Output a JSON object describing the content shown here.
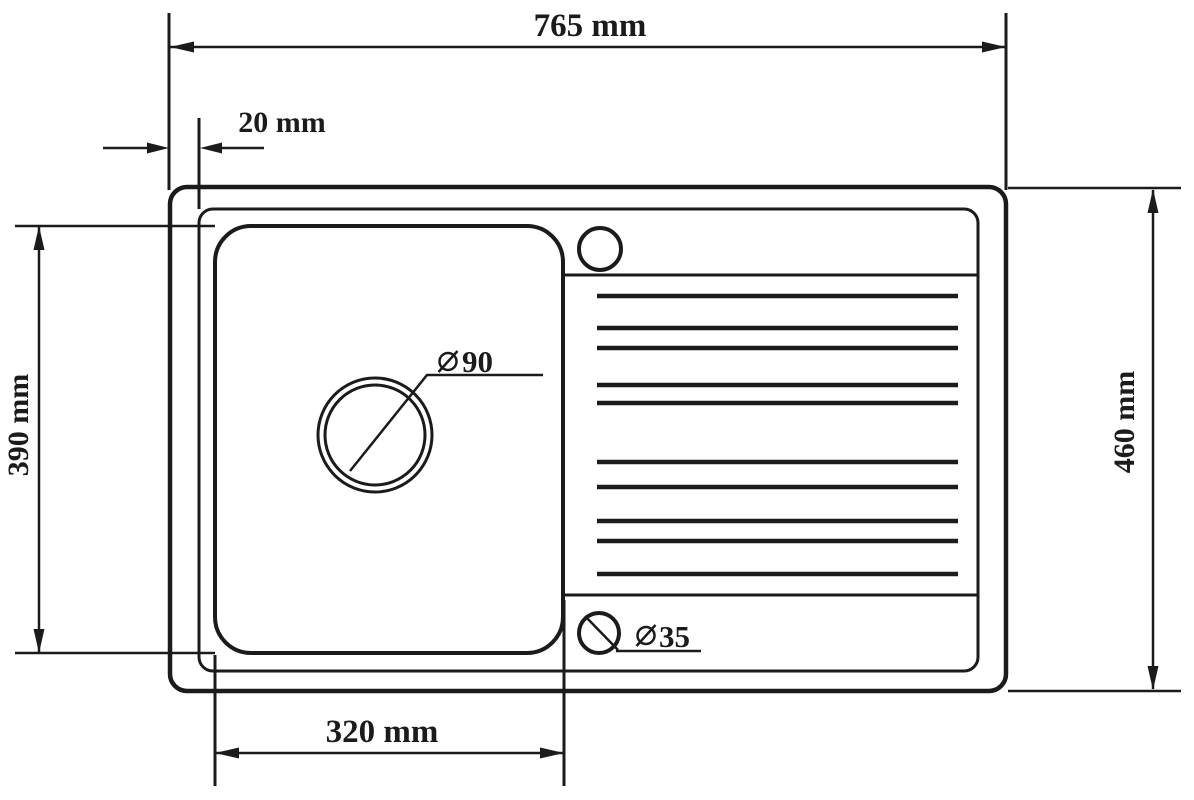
{
  "colors": {
    "ink": "#1b1b1b",
    "background": "#ffffff"
  },
  "dimensions": {
    "overall_width": {
      "label": "765 mm"
    },
    "rim_inset": {
      "label": "20 mm"
    },
    "bowl_depth": {
      "label": "390 mm"
    },
    "overall_depth": {
      "label": "460 mm"
    },
    "bowl_width": {
      "label": "320 mm"
    },
    "drain_hole": {
      "symbol": "diameter-icon",
      "value": "90"
    },
    "small_hole": {
      "symbol": "diameter-icon",
      "value": "35"
    }
  },
  "drainboard": {
    "ridge_count": 10,
    "ridge_y_positions": [
      296,
      328,
      348,
      385,
      403,
      462,
      487,
      521,
      541,
      574
    ],
    "ridge_x_start": 597,
    "ridge_x_end": 958
  }
}
